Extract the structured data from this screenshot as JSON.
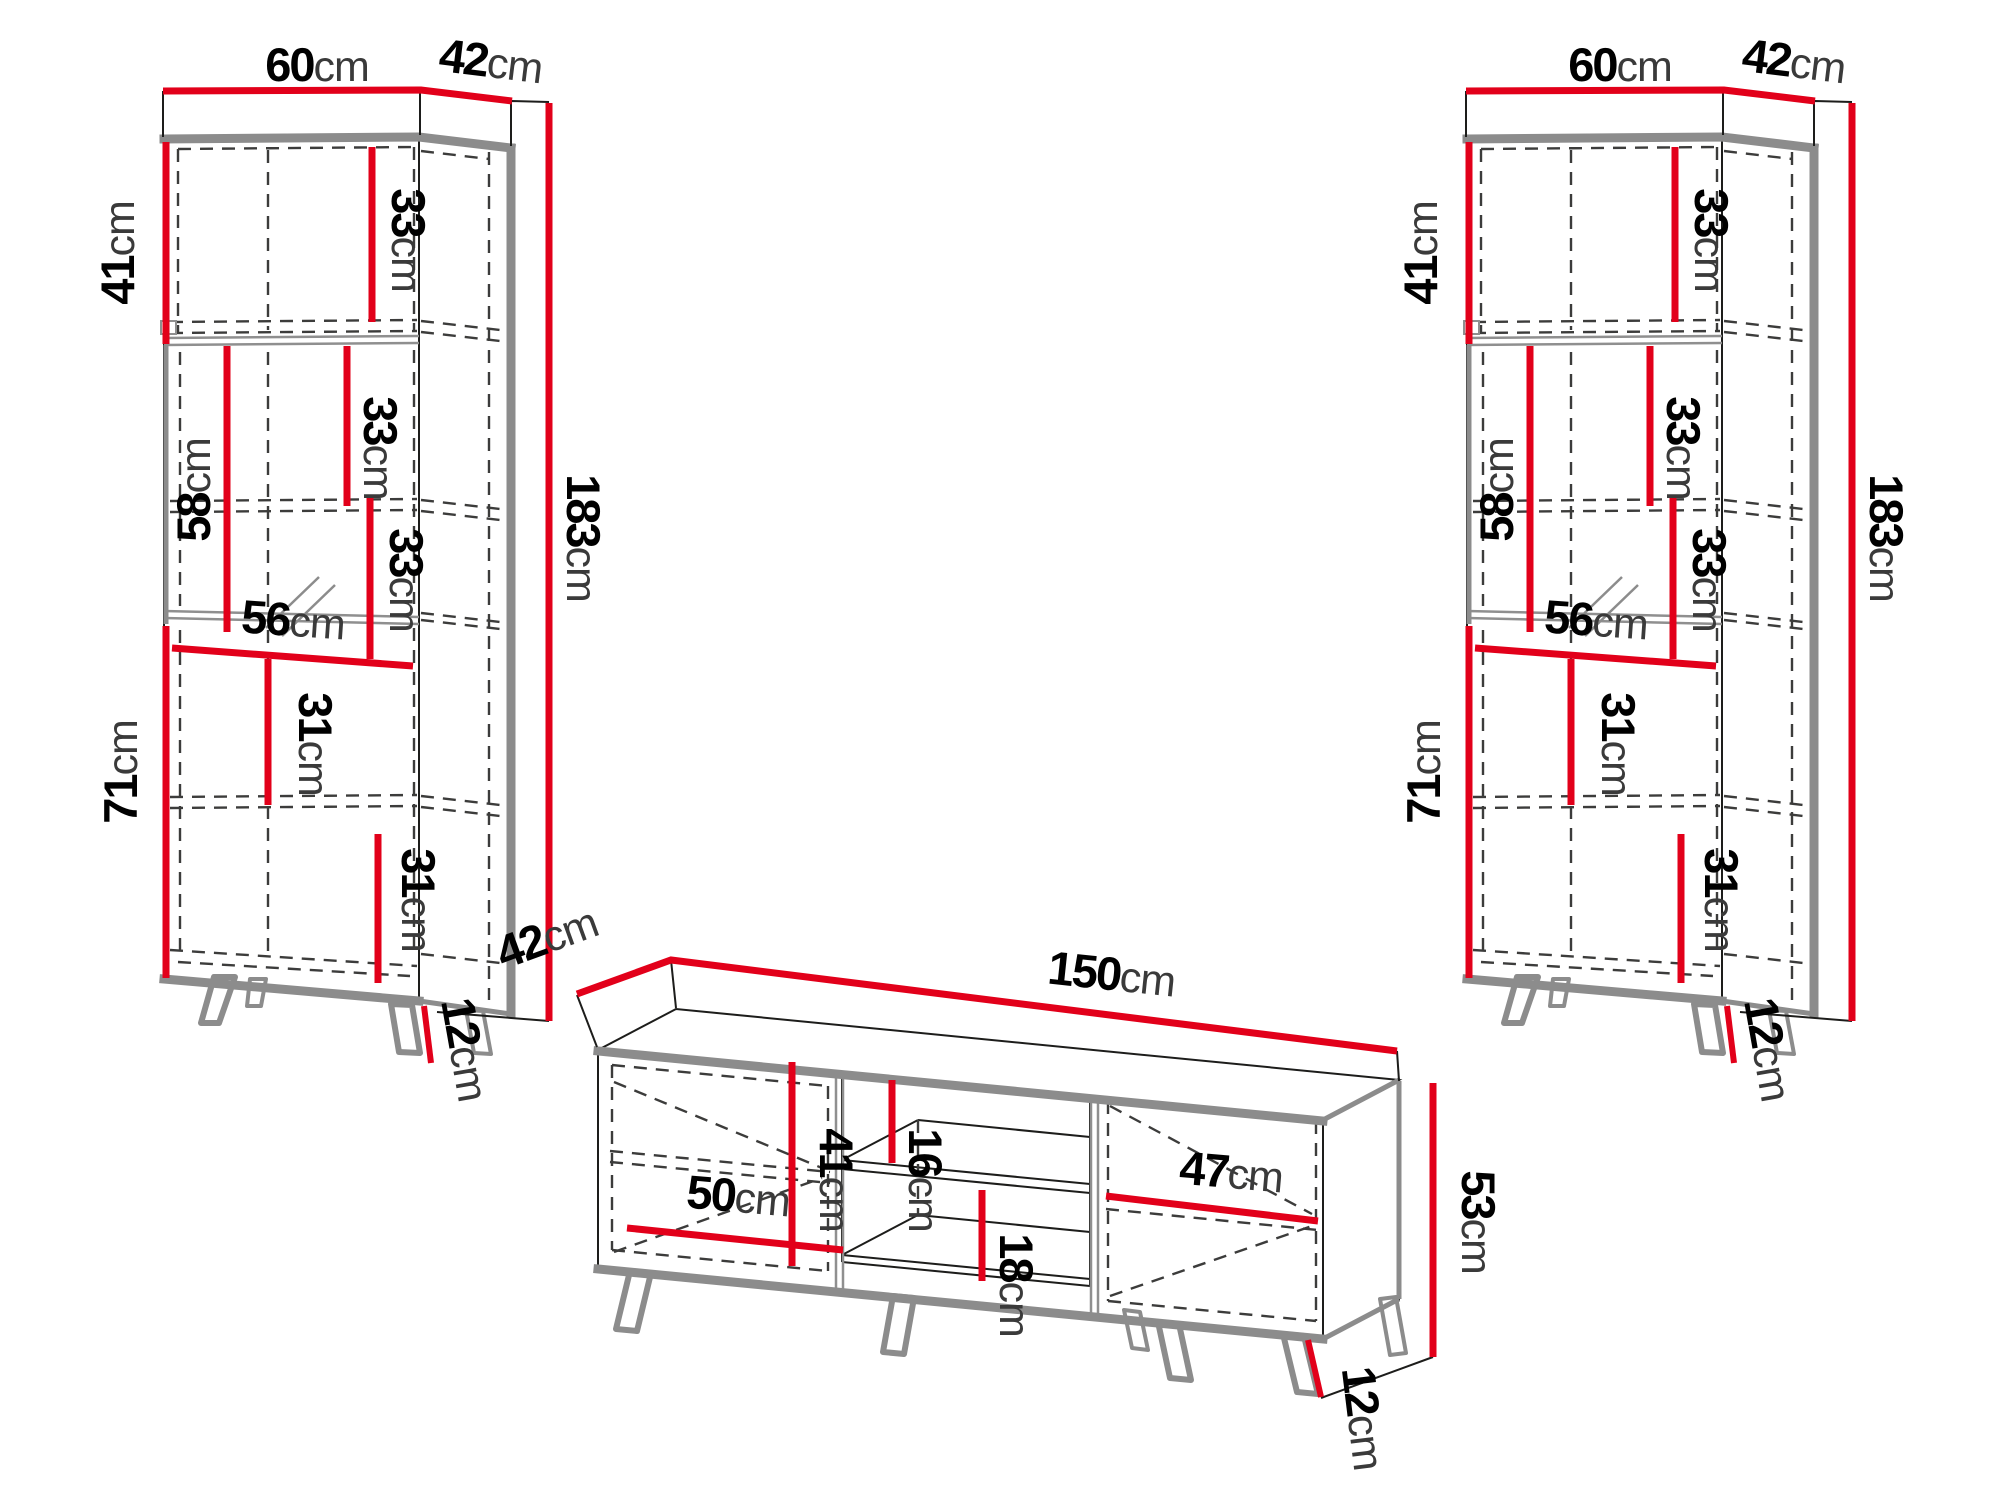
{
  "colors": {
    "dimension_line": "#e2001a",
    "panel_gray": "#8c8c8c",
    "outline": "#1d1d1b",
    "hidden_line": "#3c3c3b",
    "background": "#ffffff"
  },
  "cabinet_left": {
    "width_top": {
      "value": "60",
      "unit": "cm"
    },
    "depth_top": {
      "value": "42",
      "unit": "cm"
    },
    "upper_door_height": {
      "value": "41",
      "unit": "cm"
    },
    "upper_shelf_spacing": {
      "value": "33",
      "unit": "cm"
    },
    "middle_shelf_spacing": {
      "value": "33",
      "unit": "cm"
    },
    "lower_middle_shelf_spacing": {
      "value": "33",
      "unit": "cm"
    },
    "glass_door_height": {
      "value": "58",
      "unit": "cm"
    },
    "interior_width": {
      "value": "56",
      "unit": "cm"
    },
    "lower_door_height": {
      "value": "71",
      "unit": "cm"
    },
    "lower_shelf_spacing_1": {
      "value": "31",
      "unit": "cm"
    },
    "lower_shelf_spacing_2": {
      "value": "31",
      "unit": "cm"
    },
    "total_height": {
      "value": "183",
      "unit": "cm"
    },
    "leg_height": {
      "value": "12",
      "unit": "cm"
    }
  },
  "cabinet_right": {
    "width_top": {
      "value": "60",
      "unit": "cm"
    },
    "depth_top": {
      "value": "42",
      "unit": "cm"
    },
    "upper_door_height": {
      "value": "41",
      "unit": "cm"
    },
    "upper_shelf_spacing": {
      "value": "33",
      "unit": "cm"
    },
    "middle_shelf_spacing": {
      "value": "33",
      "unit": "cm"
    },
    "lower_middle_shelf_spacing": {
      "value": "33",
      "unit": "cm"
    },
    "glass_door_height": {
      "value": "58",
      "unit": "cm"
    },
    "interior_width": {
      "value": "56",
      "unit": "cm"
    },
    "lower_door_height": {
      "value": "71",
      "unit": "cm"
    },
    "lower_shelf_spacing_1": {
      "value": "31",
      "unit": "cm"
    },
    "lower_shelf_spacing_2": {
      "value": "31",
      "unit": "cm"
    },
    "total_height": {
      "value": "183",
      "unit": "cm"
    },
    "leg_height": {
      "value": "12",
      "unit": "cm"
    }
  },
  "tv_stand": {
    "depth_top": {
      "value": "42",
      "unit": "cm"
    },
    "width_top": {
      "value": "150",
      "unit": "cm"
    },
    "door_height": {
      "value": "41",
      "unit": "cm"
    },
    "door_width": {
      "value": "50",
      "unit": "cm"
    },
    "niche_upper_height": {
      "value": "16",
      "unit": "cm"
    },
    "niche_lower_height": {
      "value": "18",
      "unit": "cm"
    },
    "right_compartment_width": {
      "value": "47",
      "unit": "cm"
    },
    "body_height": {
      "value": "53",
      "unit": "cm"
    },
    "leg_height": {
      "value": "12",
      "unit": "cm"
    }
  }
}
